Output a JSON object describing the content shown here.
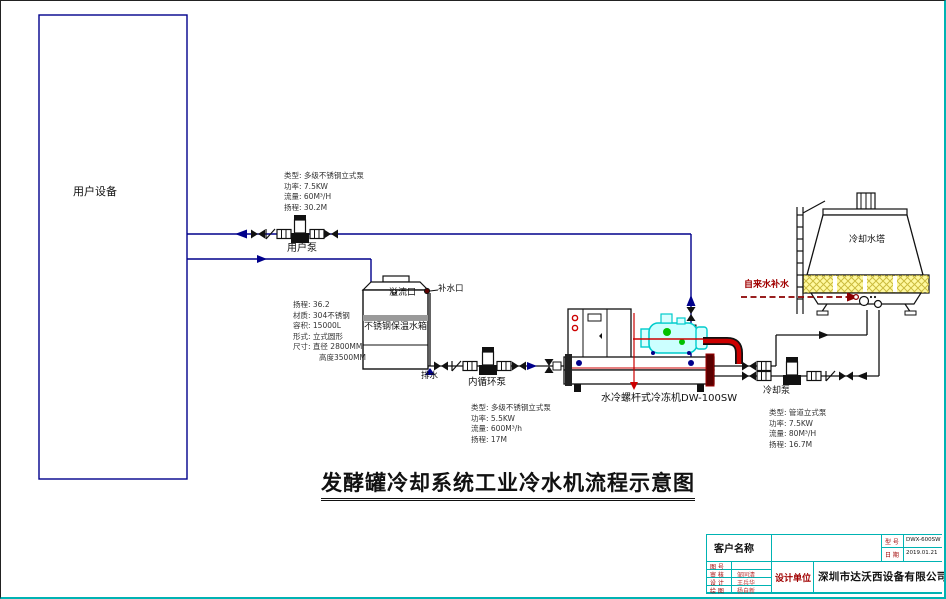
{
  "title": "发酵罐冷却系统工业冷水机流程示意图",
  "equipment": {
    "user_device": "用户设备",
    "user_pump": "用户泵",
    "tank": "不锈钢保温水箱",
    "overflow_port": "溢流口",
    "makeup_port": "补水口",
    "drain": "排水",
    "inner_pump": "内循环泵",
    "chiller": "水冷螺杆式冷冻机DW-100SW",
    "cooling_pump": "冷却泵",
    "cooling_tower": "冷却水塔",
    "tap_water_makeup": "自来水补水"
  },
  "specs": {
    "user_pump": [
      "类型: 多级不锈钢立式泵",
      "功率: 7.5KW",
      "流量: 60M³/H",
      "扬程: 30.2M"
    ],
    "tank": [
      "扬程: 36.2",
      "材质: 304不锈钢",
      "容积: 15000L",
      "形式: 立式圆形",
      "尺寸: 直径 2800MM",
      "高度3500MM"
    ],
    "inner_pump": [
      "类型: 多级不锈钢立式泵",
      "功率: 5.5KW",
      "流量: 600M³/h",
      "扬程: 17M"
    ],
    "cooling_pump": [
      "类型: 管道立式泵",
      "功率: 7.5KW",
      "流量: 80M³/H",
      "扬程: 16.7M"
    ]
  },
  "title_block": {
    "customer_label": "客户名称",
    "customer_value": "",
    "model_label": "型 号",
    "model_value": "DWX-600SW",
    "date_label": "日 期",
    "date_value": "2019.01.21",
    "rows": [
      {
        "label": "图 号",
        "value": ""
      },
      {
        "label": "审 核",
        "value": "邹同清"
      },
      {
        "label": "设 计",
        "value": "王兵华"
      },
      {
        "label": "绘 图",
        "value": "杨自新"
      }
    ],
    "designer_label": "设计单位",
    "company": "深圳市达沃西设备有限公司"
  },
  "colors": {
    "chilled_line": "#00008B",
    "refrigerant_line": "#CC0000",
    "makeup_line": "#8B0000",
    "compressor": "#00CCCC",
    "louver_fill": "#FFF9A0",
    "title_block_grid": "#00B3B3",
    "label_red": "#A00000"
  }
}
